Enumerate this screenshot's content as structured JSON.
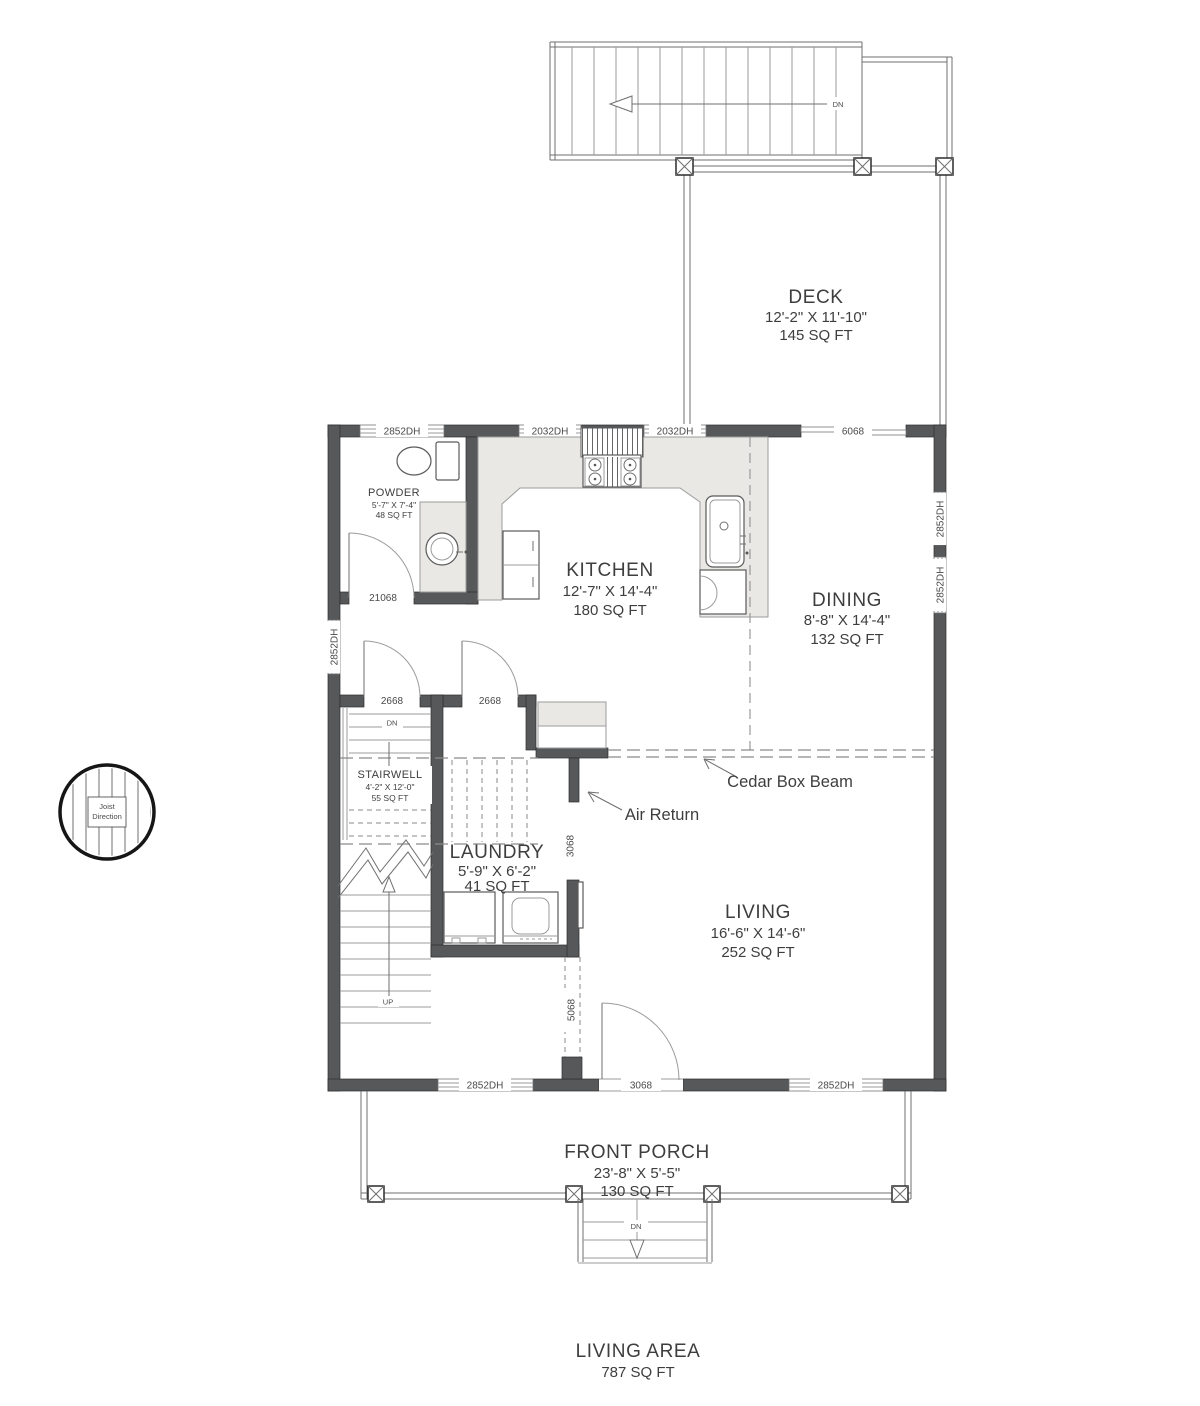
{
  "rooms": {
    "deck": {
      "name": "DECK",
      "dims": "12'-2\" X 11'-10\"",
      "area": "145 SQ FT"
    },
    "powder": {
      "name": "POWDER",
      "dims": "5'-7\" X 7'-4\"",
      "area": "48 SQ FT"
    },
    "kitchen": {
      "name": "KITCHEN",
      "dims": "12'-7\" X 14'-4\"",
      "area": "180 SQ FT"
    },
    "dining": {
      "name": "DINING",
      "dims": "8'-8\" X 14'-4\"",
      "area": "132 SQ FT"
    },
    "stairwell": {
      "name": "STAIRWELL",
      "dims": "4'-2\" X 12'-0\"",
      "area": "55 SQ FT"
    },
    "laundry": {
      "name": "LAUNDRY",
      "dims": "5'-9\" X 6'-2\"",
      "area": "41 SQ FT"
    },
    "living": {
      "name": "LIVING",
      "dims": "16'-6\" X 14'-6\"",
      "area": "252 SQ FT"
    },
    "porch": {
      "name": "FRONT PORCH",
      "dims": "23'-8\" X 5'-5\"",
      "area": "130 SQ FT"
    }
  },
  "summary": {
    "label": "LIVING AREA",
    "area": "787 SQ FT"
  },
  "annotations": {
    "cedar_box_beam": "Cedar Box Beam",
    "air_return": "Air Return",
    "down": "DN",
    "up": "UP",
    "joist_line1": "Joist",
    "joist_line2": "Direction"
  },
  "openings": {
    "window_2852dh": "2852DH",
    "window_2032dh": "2032DH",
    "slider_6068": "6068",
    "door_21068": "21068",
    "door_2668": "2668",
    "door_3068": "3068",
    "opening_5068": "5068"
  },
  "colors": {
    "wall": "#57585a",
    "counter": "#e9e8e5",
    "text": "#3e3e3e",
    "line": "#6f6f6f",
    "background": "#ffffff"
  }
}
